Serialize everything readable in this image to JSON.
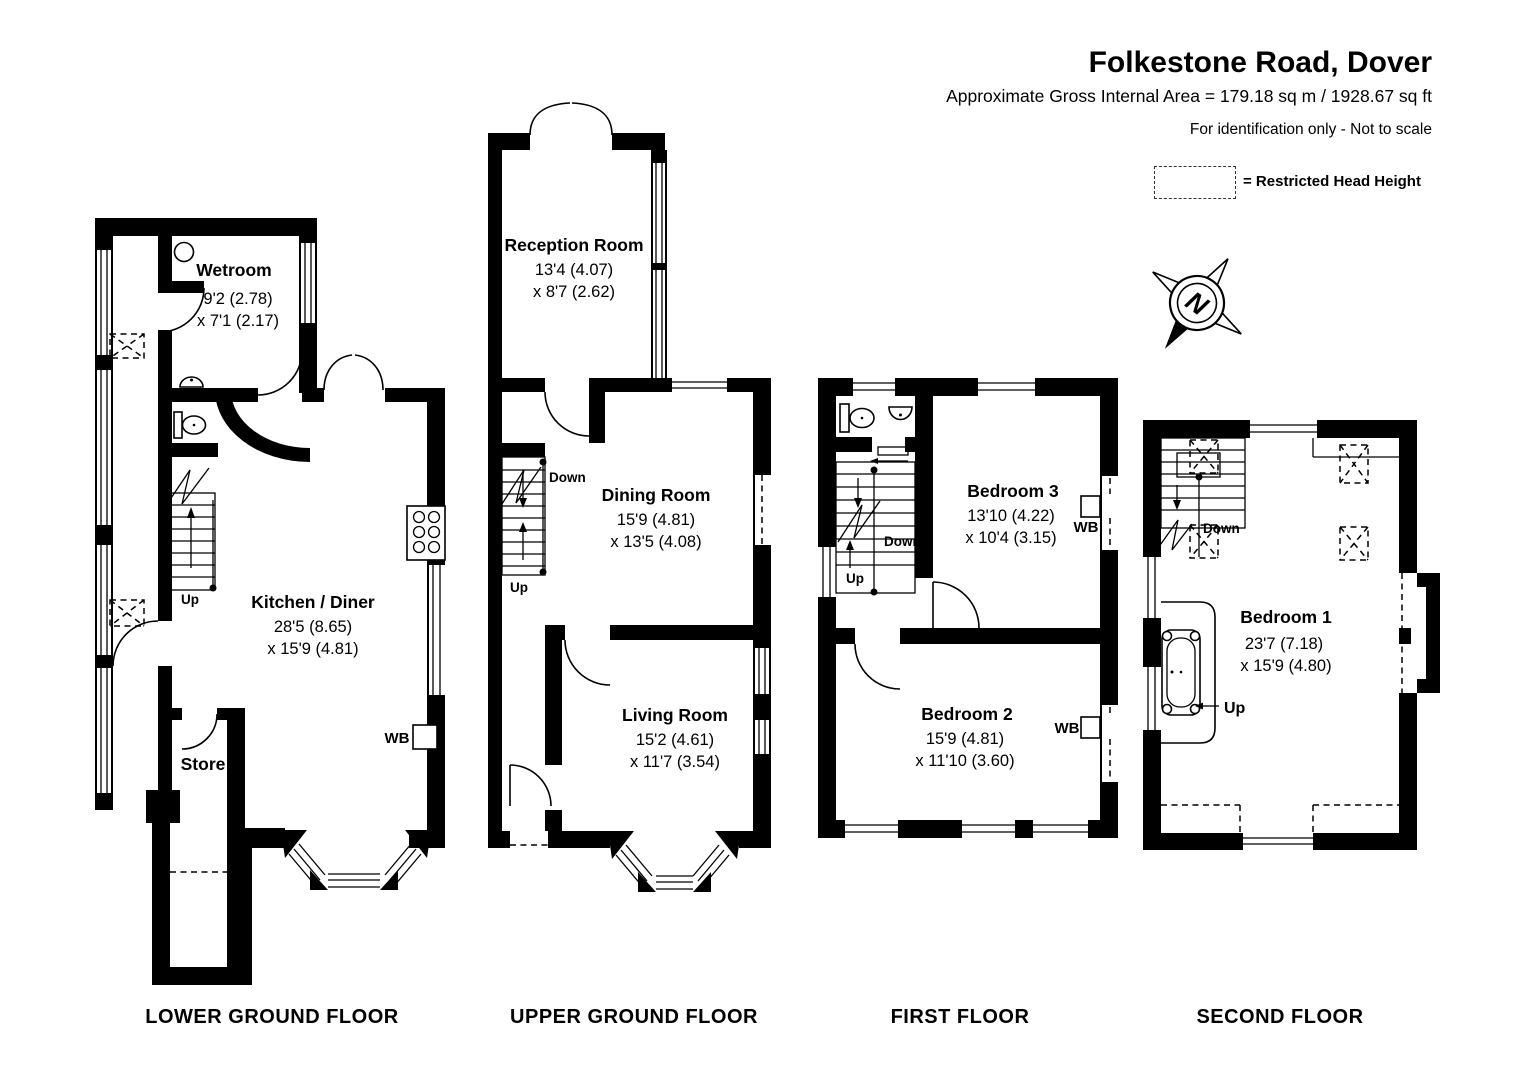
{
  "header": {
    "title": "Folkestone Road, Dover",
    "subtitle": "Approximate Gross Internal Area = 179.18 sq m / 1928.67 sq ft",
    "disclaimer": "For identification only - Not to scale",
    "legend_label": "= Restricted Head Height",
    "compass_letter": "N"
  },
  "labels": {
    "up": "Up",
    "down": "Down",
    "wb": "WB"
  },
  "floors": {
    "lower_ground": {
      "label": "LOWER GROUND FLOOR",
      "rooms": {
        "wetroom": {
          "name": "Wetroom",
          "d1": "9'2 (2.78)",
          "d2": "x 7'1 (2.17)"
        },
        "kitchen": {
          "name": "Kitchen / Diner",
          "d1": "28'5 (8.65)",
          "d2": "x 15'9 (4.81)"
        },
        "store": {
          "name": "Store"
        }
      }
    },
    "upper_ground": {
      "label": "UPPER GROUND FLOOR",
      "rooms": {
        "reception": {
          "name": "Reception Room",
          "d1": "13'4 (4.07)",
          "d2": "x 8'7 (2.62)"
        },
        "dining": {
          "name": "Dining Room",
          "d1": "15'9 (4.81)",
          "d2": "x 13'5 (4.08)"
        },
        "living": {
          "name": "Living Room",
          "d1": "15'2 (4.61)",
          "d2": "x 11'7 (3.54)"
        }
      }
    },
    "first": {
      "label": "FIRST FLOOR",
      "rooms": {
        "bedroom3": {
          "name": "Bedroom 3",
          "d1": "13'10 (4.22)",
          "d2": "x 10'4 (3.15)"
        },
        "bedroom2": {
          "name": "Bedroom 2",
          "d1": "15'9 (4.81)",
          "d2": "x 11'10 (3.60)"
        }
      }
    },
    "second": {
      "label": "SECOND FLOOR",
      "rooms": {
        "bedroom1": {
          "name": "Bedroom 1",
          "d1": "23'7 (7.18)",
          "d2": "x 15'9 (4.80)"
        }
      }
    }
  }
}
